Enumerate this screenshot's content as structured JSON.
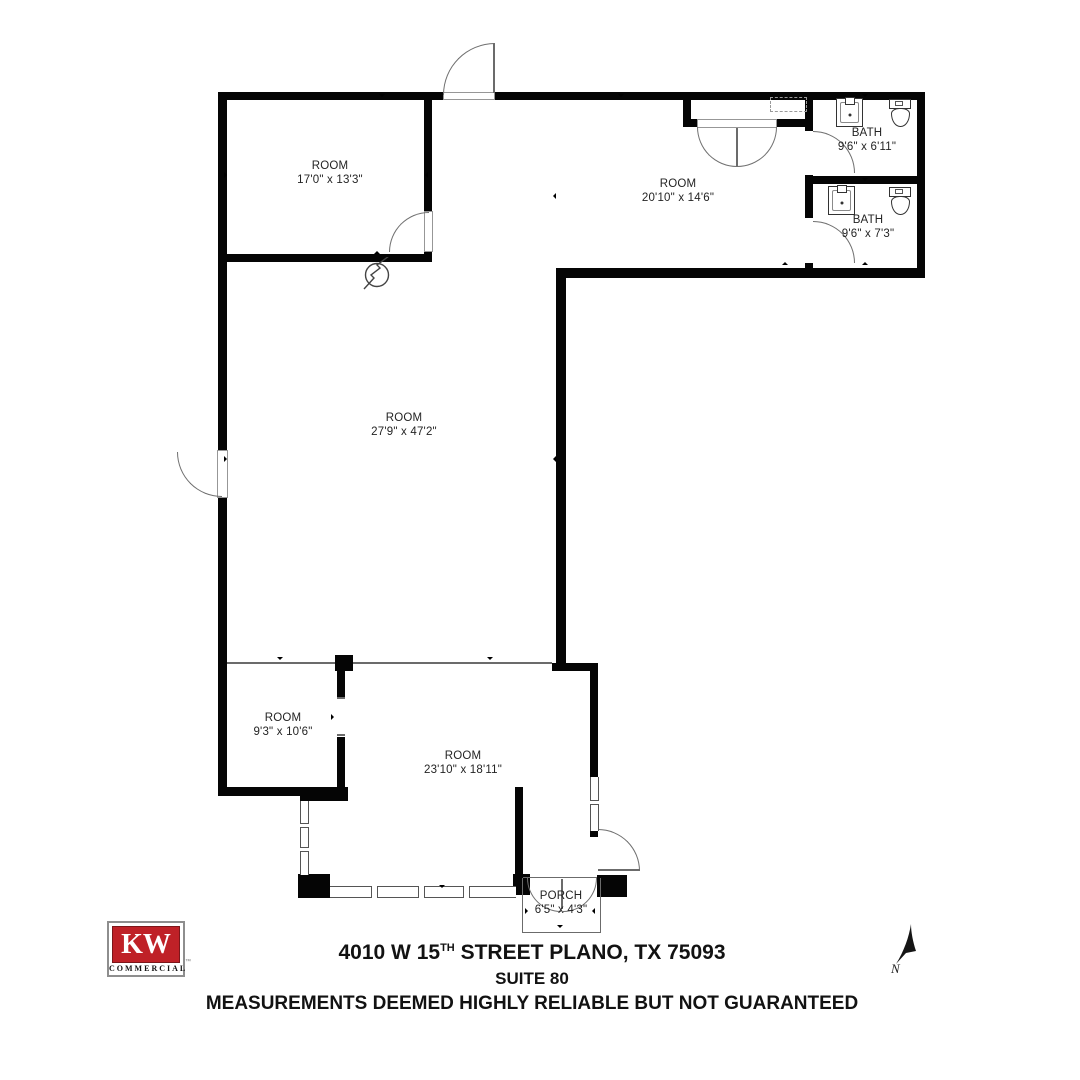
{
  "rooms": [
    {
      "name": "ROOM",
      "dims": "17'0\" x 13'3\""
    },
    {
      "name": "ROOM",
      "dims": "20'10\" x 14'6\""
    },
    {
      "name": "BATH",
      "dims": "9'6\" x 6'11\""
    },
    {
      "name": "BATH",
      "dims": "9'6\" x 7'3\""
    },
    {
      "name": "ROOM",
      "dims": "27'9\" x 47'2\""
    },
    {
      "name": "ROOM",
      "dims": "9'3\" x 10'6\""
    },
    {
      "name": "ROOM",
      "dims": "23'10\" x 18'11\""
    },
    {
      "name": "PORCH",
      "dims": "6'5\" x 4'3\""
    }
  ],
  "fixtures": {
    "bath_top": [
      "sink",
      "toilet"
    ],
    "bath_bottom": [
      "sink",
      "toilet"
    ]
  },
  "logo": {
    "kw": "KW",
    "word": "COMMERCIAL",
    "tm": "™"
  },
  "compass": {
    "label": "N"
  },
  "footer": {
    "address_prefix": "4010 W 15",
    "address_superscript": "TH",
    "address_suffix": " STREET PLANO, TX 75093",
    "suite": "SUITE 80",
    "disclaimer": "MEASUREMENTS DEEMED HIGHLY RELIABLE BUT NOT GUARANTEED"
  },
  "colors": {
    "wall": "#050505",
    "thin_line": "#6b6b6b",
    "label_text": "#242424",
    "kw_red": "#bf2127",
    "footer_text": "#121212"
  }
}
